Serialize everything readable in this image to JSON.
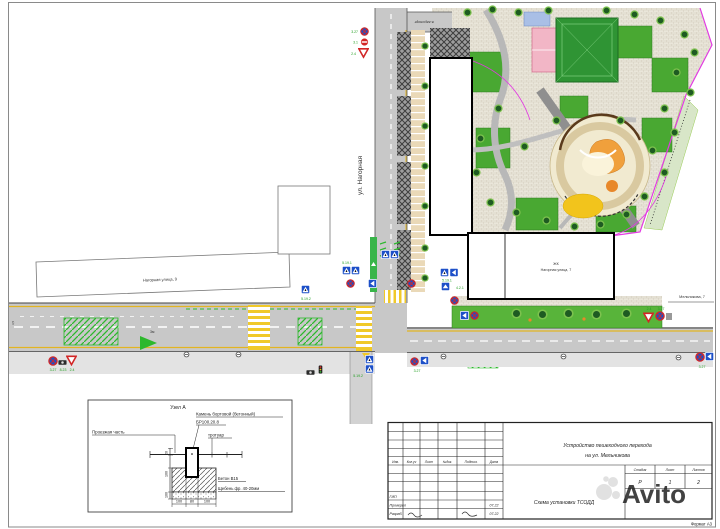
{
  "page": {
    "format_label": "Формат А3",
    "watermark": "Avito"
  },
  "map": {
    "street_vertical": "ул. Нагорная",
    "street_top_note": "в аэропорт",
    "building_left_label": "Нагорная улица, 9",
    "jk_label": "ЖК",
    "building_right_label": "Нагорная улица, 7",
    "building_far_right_label": "Мельникова, 7",
    "lane_note": "3м",
    "lane_width": "3,5"
  },
  "codes": {
    "no_stop": "3.27",
    "no_entry": "3.1",
    "give_way": "2.4",
    "camera": "8.23",
    "ped1": "5.19.1",
    "ped2": "5.19.2",
    "blue_arrow": "4.2.1"
  },
  "node": {
    "title": "Узел А",
    "stone1": "Камень бортовой (бетонный)",
    "stone2": "БР100.20.8",
    "roadway": "Проезжая часть",
    "sidewalk": "тротуар",
    "concrete": "Бетон В15",
    "gravel": "Щебень фр. 40-20мм",
    "d1": "100",
    "d2": "80",
    "d3": "100",
    "v1": "20",
    "v2": "100",
    "v3": "100"
  },
  "stamp": {
    "c1": "Изм.",
    "c2": "Кол.уч",
    "c3": "Лист",
    "c4": "№док.",
    "c5": "Подпись",
    "c6": "Дата",
    "gip": "ГИП",
    "checked": "Проверил",
    "dev": "Разраб.",
    "date1": "07.22",
    "date2": "07.22",
    "title1": "Устройство пешеходного перехода",
    "title2": "на ул. Мельникова",
    "doc": "Схема установки ТСОДД",
    "stage_l": "Стадия",
    "sheet_l": "Лист",
    "sheets_l": "Листов",
    "stage": "Р",
    "sheet": "1",
    "sheets": "2"
  }
}
